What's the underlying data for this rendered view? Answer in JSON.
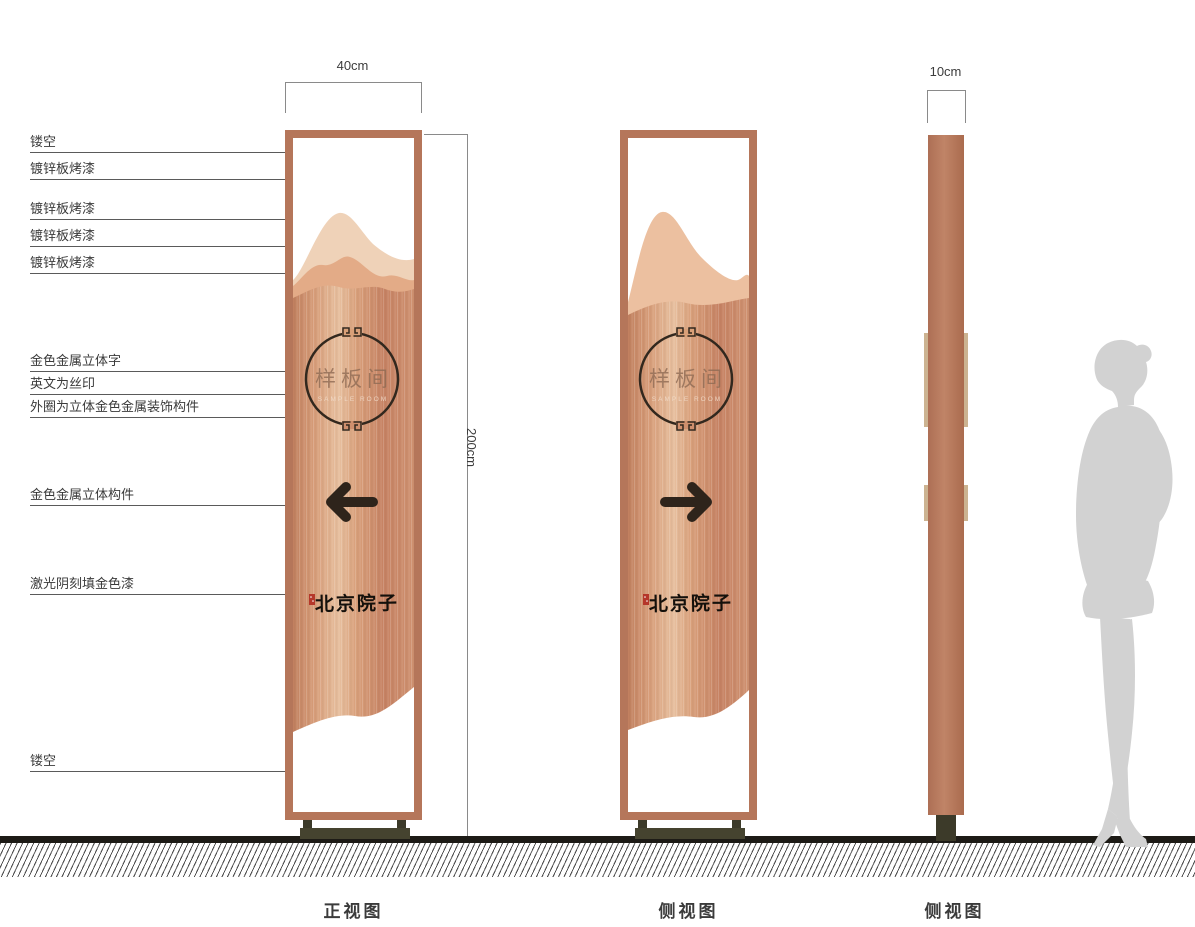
{
  "annotations": {
    "left": [
      {
        "label": "镂空"
      },
      {
        "label": "镀锌板烤漆"
      },
      {
        "label": "镀锌板烤漆"
      },
      {
        "label": "镀锌板烤漆"
      },
      {
        "label": "镀锌板烤漆"
      },
      {
        "label": "金色金属立体字"
      },
      {
        "label": "英文为丝印"
      },
      {
        "label": "外圈为立体金色金属装饰构件"
      },
      {
        "label": "金色金属立体构件"
      },
      {
        "label": "激光阴刻填金色漆"
      },
      {
        "label": "镂空"
      }
    ]
  },
  "dimensions": {
    "front_width": "40cm",
    "height": "200cm",
    "side_width": "10cm"
  },
  "sign": {
    "room_name": "样板间",
    "room_name_en": "SAMPLE ROOM",
    "brand_name": "北京院子"
  },
  "views": {
    "front_label": "正视图",
    "side_label_1": "侧视图",
    "side_label_2": "侧视图"
  },
  "colors": {
    "copper_frame": "#b5765a",
    "copper_body": "#cf9170",
    "copper_highlight": "#ecc8ab",
    "mountain_light": "#efd2b8",
    "mountain_mid": "#e3ab87",
    "accent_dark": "#32281e",
    "base_olive": "#45432f",
    "seal_red": "#b5372a",
    "silhouette_gray": "#d2d2d2"
  }
}
